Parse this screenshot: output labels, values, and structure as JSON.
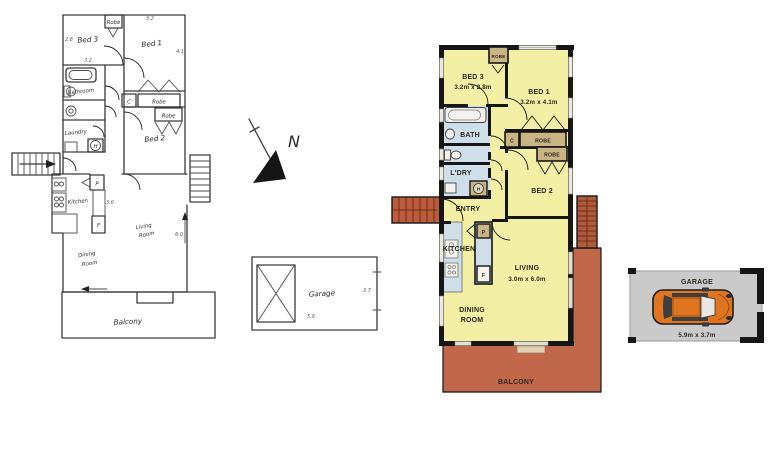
{
  "compass": {
    "label": "N"
  },
  "sketch": {
    "labels": {
      "bed3": "Bed 3",
      "bed1": "Bed 1",
      "bed2": "Bed 2",
      "bathroom": "Bathroom",
      "laundry": "Laundry",
      "kitchen": "Kitchen",
      "living_line1": "Living",
      "living_line2": "Room",
      "dining_line1": "Dining",
      "dining_line2": "Room",
      "balcony": "Balcony",
      "garage": "Garage",
      "robe_top": "Robe",
      "robe_bed1": "Robe",
      "robe_bed2": "Robe",
      "closet_c": "C",
      "hot_water_h": "H",
      "pantry_p": "P",
      "fridge_f": "F"
    },
    "dims": {
      "bed3_width": "3.2",
      "bed3_depth": "2.8",
      "bed1_width": "3.2",
      "bed1_depth": "4.1",
      "living_depth": "6.0",
      "kitchen_width": "3.0",
      "garage_width": "5.9",
      "garage_depth": "3.7"
    }
  },
  "plan": {
    "rooms": {
      "bed3_name": "BED 3",
      "bed3_dims": "3.2m x 2.8m",
      "bed1_name": "BED 1",
      "bed1_dims": "3.2m x 4.1m",
      "bed2_name": "BED 2",
      "bath": "BATH",
      "laundry": "L'DRY",
      "entry": "ENTRY",
      "kitchen": "KITCHEN",
      "living_name": "LIVING",
      "living_dims": "3.0m x 6.0m",
      "dining_line1": "DINING",
      "dining_line2": "ROOM",
      "balcony": "BALCONY"
    },
    "fixtures": {
      "robe_top": "ROBE",
      "robe_bed1": "ROBE",
      "robe_bed2": "ROBE",
      "closet_c": "C",
      "pantry_p": "P",
      "fridge_f": "F",
      "hot_water_h": "H"
    },
    "colors": {
      "room_yellow": "#f3efa4",
      "wet_blue": "#cfdfe9",
      "robe_tan": "#c9b484",
      "balcony_terracotta": "#c2684a",
      "stairs_brick": "#b05a3c",
      "wall_black": "#161616"
    }
  },
  "garage": {
    "title": "GARAGE",
    "dims": "5.9m x 3.7m",
    "car_color": "#e0751f",
    "floor_color": "#cacaca"
  }
}
